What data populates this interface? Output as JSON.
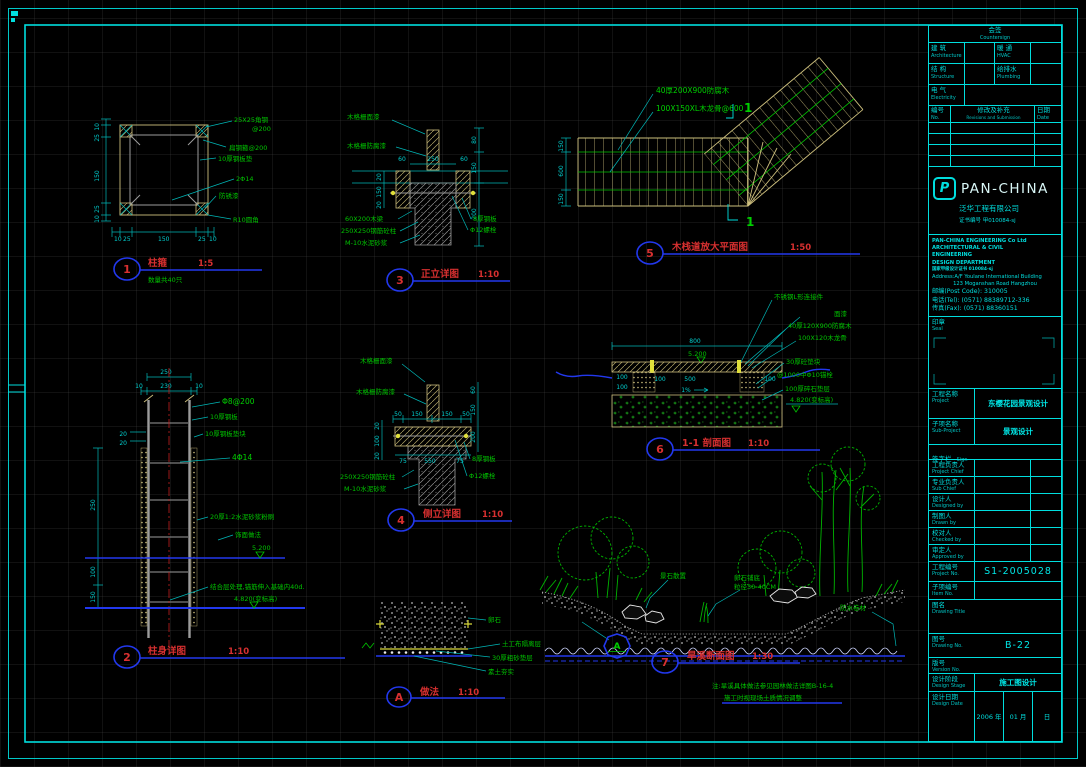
{
  "sheet": {
    "bg": "#000000",
    "accent_cyan": "#00dede",
    "accent_green": "#00c400",
    "accent_red": "#d83030",
    "accent_blue": "#2238ee",
    "wood": "#cdbf7d"
  },
  "details": {
    "d1": {
      "num": "1",
      "title": "柱箍",
      "scale": "1:5",
      "note": "数量共40只",
      "labels": [
        "25X25角钢",
        "@200",
        "扁钢箍@200",
        "10厚钢板垫",
        "2Φ14",
        "防锈漆",
        "R10圆角"
      ],
      "dims_bottom": [
        "10",
        "25",
        "150",
        "25",
        "10"
      ],
      "dims_left": [
        "10",
        "25",
        "150",
        "25",
        "10"
      ]
    },
    "d2": {
      "num": "2",
      "title": "柱身详图",
      "scale": "1:10",
      "labels": [
        "Φ8@200",
        "10厚钢板",
        "10厚钢板垫块",
        "4Φ14",
        "20厚1:2水泥砂浆粉刷",
        "饰面做法",
        "结合层处理,锚筋伸入基础内40d."
      ],
      "levels": [
        "5.200",
        "4.820(变标高)"
      ],
      "dims_top": [
        "250",
        "230",
        "10",
        "10"
      ],
      "dims_small": [
        "20",
        "20"
      ],
      "dims_left": [
        "250",
        "100",
        "150"
      ]
    },
    "d3": {
      "num": "3",
      "title": "正立详图",
      "scale": "1:10",
      "labels_left": [
        "木格栅面漆",
        "木格栅防腐漆",
        "60X200木梁",
        "250X250钢筋砼柱",
        "M-10水泥砂浆"
      ],
      "labels_right": [
        "8厚钢板",
        "Φ12螺栓"
      ],
      "dim_top": "250",
      "dims_60": [
        "60",
        "60"
      ],
      "dims_right": [
        "80",
        "150",
        "200"
      ],
      "dims_left": [
        "20",
        "150",
        "20"
      ]
    },
    "d4": {
      "num": "4",
      "title": "侧立详图",
      "scale": "1:10",
      "labels_left": [
        "木格栅面漆",
        "木格栅防腐漆",
        "250X250钢筋砼柱",
        "M-10水泥砂浆"
      ],
      "labels_right": [
        "8厚钢板",
        "Φ12螺栓"
      ],
      "dims_top": [
        "50",
        "150",
        "150",
        "50"
      ],
      "dims_left": [
        "20",
        "100",
        "20"
      ],
      "dims_right": [
        "60",
        "150",
        "200"
      ],
      "dims_bottom": [
        "75",
        "550",
        "75"
      ]
    },
    "d5": {
      "num": "5",
      "title": "木栈道放大平面图",
      "scale": "1:50",
      "section": "1",
      "labels": [
        "40厚200X900防腐木",
        "100X150XL木龙骨@600"
      ],
      "dims_left": [
        "150",
        "600",
        "150"
      ]
    },
    "d6": {
      "num": "6",
      "title": "1-1 剖面图",
      "scale": "1:10",
      "labels": [
        "不锈钢L形连接件",
        "面漆",
        "40厚120X900防腐木",
        "100X120木龙骨",
        "30厚砼垫块",
        "@1000中Φ10锚栓",
        "100厚碎石垫层"
      ],
      "levels": [
        "5.200",
        "4.820(变标高)"
      ],
      "dim_width": "800",
      "dim_span": "500",
      "slope": "1%",
      "dims_100": [
        "100",
        "100",
        "100",
        "100"
      ]
    },
    "d7": {
      "num": "7",
      "title": "旱溪断面图",
      "scale": "1:30",
      "ref": "A",
      "labels": [
        "景石散置",
        "卵石铺底",
        "粒径30-40CM",
        "防水卷材"
      ],
      "notes": [
        "注:旱溪具体做法参见园林做法详图B-16-4",
        "施工时视现场土质情况调整"
      ]
    },
    "dA": {
      "num": "A",
      "title": "做法",
      "scale": "1:10",
      "labels": [
        "卵石",
        "土工布隔离层",
        "30厚粗砂垫层",
        "素土夯实"
      ]
    }
  },
  "titleblock": {
    "countersign": {
      "cn": "会签",
      "en": "Countersign",
      "cells": [
        {
          "cn": "建 筑",
          "en": "Architecture"
        },
        {
          "cn": "暖 通",
          "en": "HVAC"
        },
        {
          "cn": "结 构",
          "en": "Structure"
        },
        {
          "cn": "给排水",
          "en": "Plumbing"
        },
        {
          "cn": "电 气",
          "en": "Electricity"
        }
      ]
    },
    "revisions": {
      "no_cn": "编号",
      "no_en": "No.",
      "rev_cn": "修改及补充",
      "rev_en": "Revisions and Submission",
      "date_cn": "日期",
      "date_en": "Date"
    },
    "brand": {
      "logo": "P",
      "name": "PAN-CHINA",
      "company": "泛华工程有限公司",
      "cert": "证书编号 甲010084-sj"
    },
    "firm": [
      "PAN-CHINA ENGINEERING Co Ltd",
      "ARCHITECTURAL & CIVIL",
      "ENGINEERING",
      "DESIGN DEPARTMENT",
      "国家甲级设计证书 010084-sj"
    ],
    "address": [
      "Address:A/F Youlane International Building",
      "123 Moganshan Road Hangzhou"
    ],
    "contact": [
      "邮编(Post Code):  310005",
      "电话(Tel):  (0571) 88389712-336",
      "传真(Fax): (0571) 88360151"
    ],
    "seal": {
      "cn": "印章",
      "en": "Seal"
    },
    "fields": [
      {
        "cn": "工程名称",
        "en": "Project",
        "value": "东樱花园景观设计"
      },
      {
        "cn": "子项名称",
        "en": "Sub-Project",
        "value": "景观设计"
      },
      {
        "cn": "签字栏",
        "en": "Sign",
        "value": ""
      },
      {
        "cn": "工程负责人",
        "en": "Project Chief",
        "value": ""
      },
      {
        "cn": "专业负责人",
        "en": "Sub Chief",
        "value": ""
      },
      {
        "cn": "设计人",
        "en": "Designed by",
        "value": ""
      },
      {
        "cn": "制图人",
        "en": "Drawn by",
        "value": ""
      },
      {
        "cn": "校对人",
        "en": "Checked by",
        "value": ""
      },
      {
        "cn": "审定人",
        "en": "Approved by",
        "value": ""
      },
      {
        "cn": "工程编号",
        "en": "Project No.",
        "value": "S1-2005028"
      },
      {
        "cn": "子项编号",
        "en": "Item No.",
        "value": ""
      },
      {
        "cn": "图名",
        "en": "Drawing Title",
        "value": "景架、木栈道、旱溪详图"
      },
      {
        "cn": "图号",
        "en": "Drawing No.",
        "value": "B-22"
      },
      {
        "cn": "版号",
        "en": "Version No.",
        "value": ""
      },
      {
        "cn": "设计阶段",
        "en": "Design Stage",
        "value": "施工图设计"
      }
    ],
    "date_label": {
      "cn": "设计日期",
      "en": "Design Date"
    },
    "date_cells": [
      "2006 年",
      "01 月",
      "日"
    ]
  }
}
